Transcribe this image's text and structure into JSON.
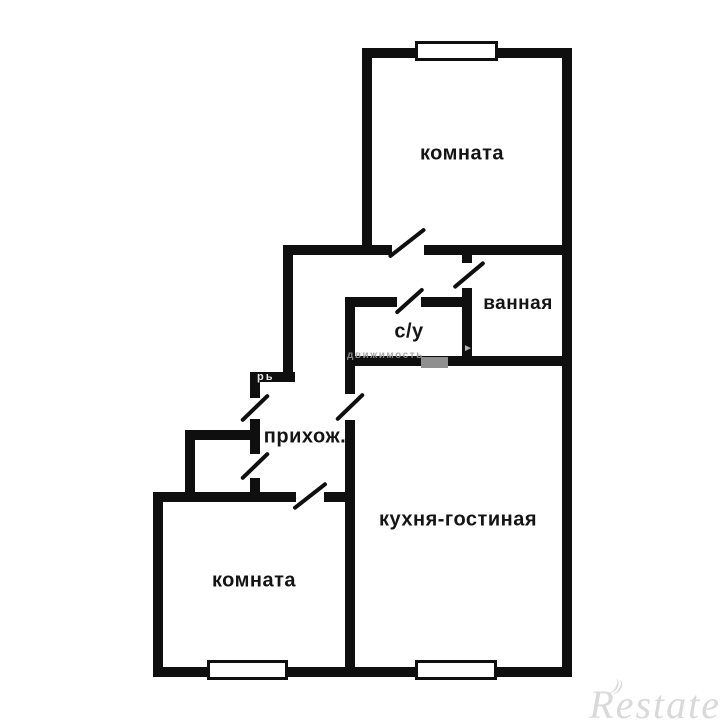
{
  "canvas": {
    "background": "#ffffff",
    "wall_color": "#0f0f0f"
  },
  "rooms": {
    "room_top": {
      "label": "комната"
    },
    "bathroom": {
      "label": "ванная"
    },
    "wc": {
      "label": "с/у"
    },
    "hallway": {
      "label": "прихож."
    },
    "kitchen_living": {
      "label": "кухня-гостиная"
    },
    "room_left": {
      "label": "комната"
    }
  },
  "watermarks": {
    "strip_text": "движимость",
    "wall_fragment": "рь",
    "arrow_glyph": "►",
    "logo_text": "Restate",
    "logo_arcs": "))"
  }
}
